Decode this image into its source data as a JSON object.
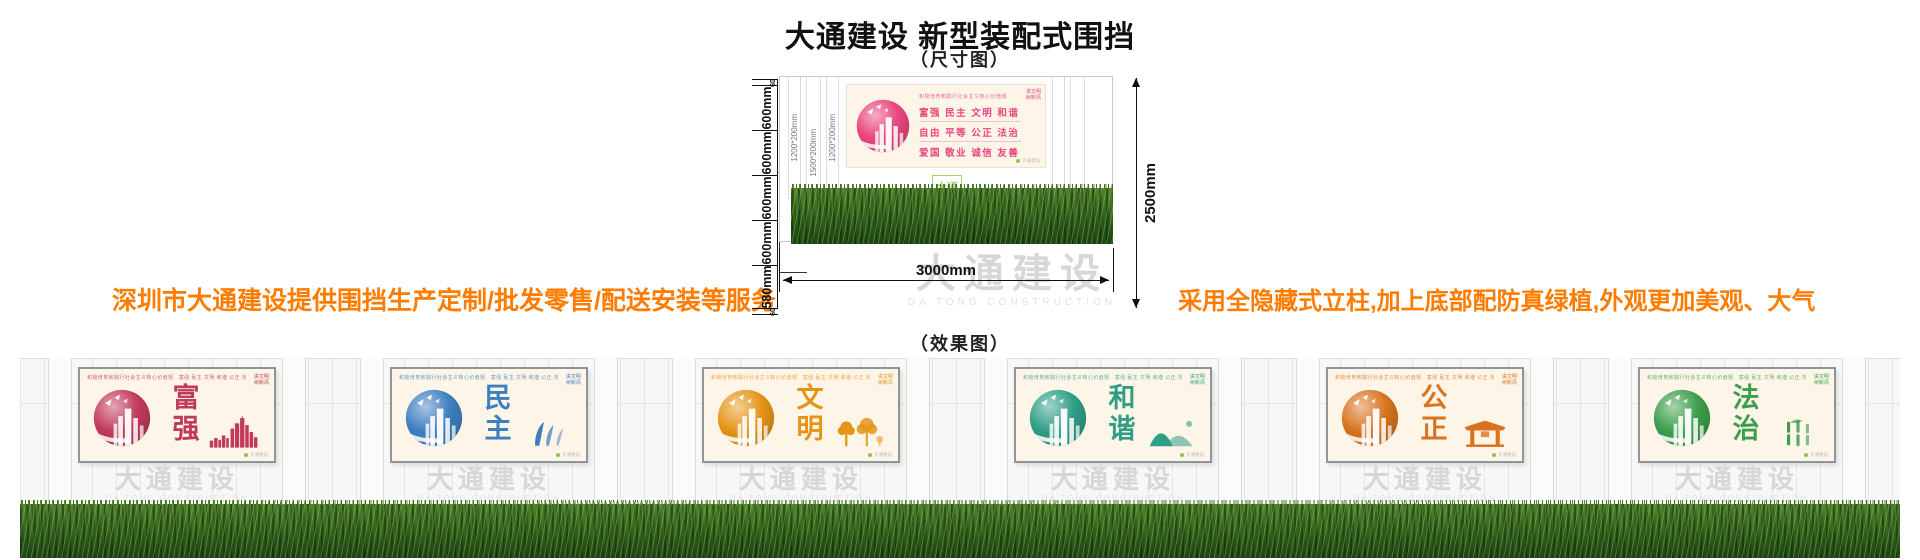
{
  "header": {
    "title": "大通建设 新型装配式围挡",
    "dim_caption": "（尺寸图）",
    "effect_caption": "（效果图）"
  },
  "notes": {
    "left": "深圳市大通建设提供围挡生产定制/批发零售/配送安装等服务",
    "right": "采用全隐藏式立柱,加上底部配防真绿植,外观更加美观、大气",
    "color": "#ff7c00"
  },
  "brand": {
    "cn": "大通建设",
    "en": "DA TONG CONSTRUCTION",
    "logo_lines": [
      "大通",
      "建设"
    ],
    "logo_green": "#8cc63f"
  },
  "dimension_diagram": {
    "left_dims": [
      "60",
      "600mm",
      "600mm",
      "600mm",
      "600mm",
      "580mm",
      "60"
    ],
    "right_dim": "2500mm",
    "bottom_dim": "3000mm",
    "column_labels": [
      "1200*200mm",
      "1500*200mm",
      "1200*200mm"
    ],
    "values_panel": {
      "slogan": "积极培育和践行社会主义核心价值观",
      "rows": [
        "富强  民主  文明  和谐",
        "自由  平等  公正  法治",
        "爱国  敬业  诚信  友善"
      ],
      "corner_lines": [
        "讲文明",
        "树新风"
      ],
      "accent": "#e8457e"
    }
  },
  "effect": {
    "panel_slogan": "积极培育和践行社会主义核心价值观",
    "panel_values": "富强 民主 文明 和谐 公正 法治 爱国 敬业 诚信 友善",
    "corner_lines": [
      "讲文明",
      "树新风"
    ],
    "panels": [
      {
        "word": "富强",
        "accent": "#c13a5a",
        "icon": "skyline-icon"
      },
      {
        "word": "民主",
        "accent": "#3d7fc0",
        "icon": "figures-icon"
      },
      {
        "word": "文明",
        "accent": "#e59418",
        "icon": "trees-icon"
      },
      {
        "word": "和谐",
        "accent": "#2f9e85",
        "icon": "mountain-icon"
      },
      {
        "word": "公正",
        "accent": "#d9731f",
        "icon": "gate-icon"
      },
      {
        "word": "法治",
        "accent": "#3c9e4c",
        "icon": "bamboo-icon"
      }
    ]
  }
}
